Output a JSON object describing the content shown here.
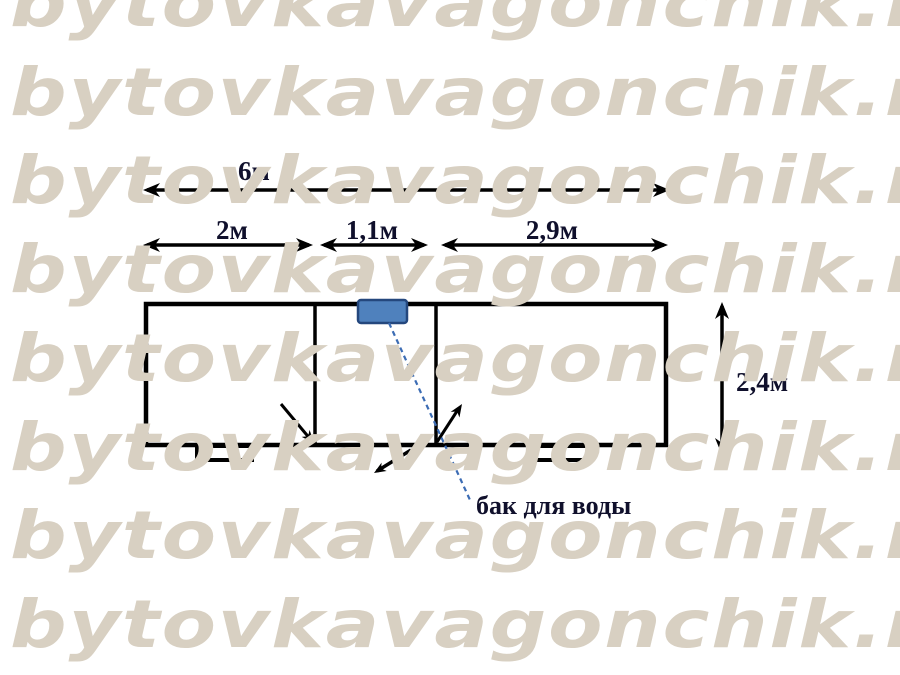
{
  "watermark": {
    "text": "bytovkavagonchik.ru",
    "rows": 8,
    "row_spacing_px": 88.7,
    "first_row_top_px": -29,
    "color": "#d8d0c2"
  },
  "diagram": {
    "title_context": "cabin floor plan with dimensions",
    "dimensions": {
      "total_width": "6м",
      "section_left": "2м",
      "section_middle": "1,1м",
      "section_right": "2,9м",
      "height": "2,4м"
    },
    "annotations": {
      "water_tank_label": "бак для воды"
    },
    "colors": {
      "line": "#000000",
      "label_text": "#10102c",
      "tank_fill": "#4f81bd",
      "tank_border": "#24477d",
      "leader_line": "#3c6cb4",
      "watermark": "#d8d0c2"
    }
  }
}
